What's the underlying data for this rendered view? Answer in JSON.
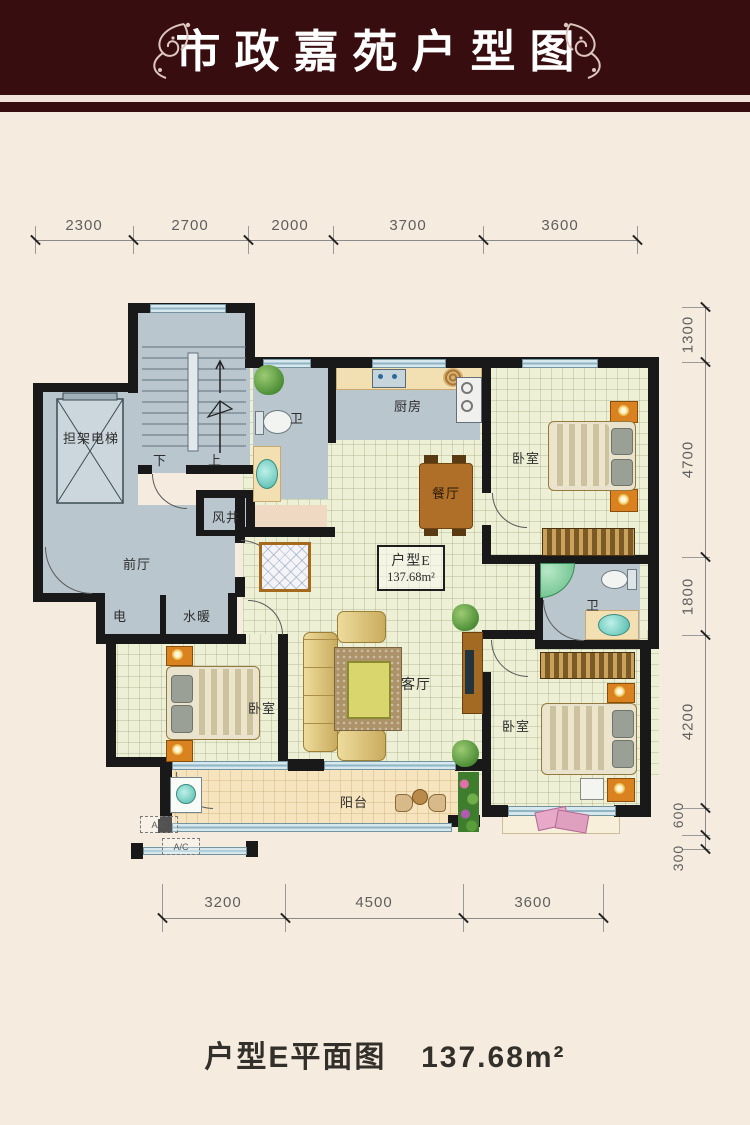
{
  "header": {
    "title": "市政嘉苑户型图"
  },
  "plan": {
    "unit_box": {
      "name": "户型E",
      "area": "137.68m²"
    },
    "labels": {
      "elevator": "担架电梯",
      "stair_down": "下",
      "stair_up": "上",
      "air_shaft": "风井",
      "front_hall": "前厅",
      "electric": "电",
      "plumbing": "水暖",
      "bath_top": "卫",
      "kitchen": "厨房",
      "dining": "餐厅",
      "bedroom_top_right": "卧室",
      "bath_right": "卫",
      "living": "客厅",
      "bedroom_left": "卧室",
      "bedroom_bottom_right": "卧室",
      "balcony": "阳台",
      "ac_1": "A/C",
      "ac_2": "A/C"
    },
    "dimensions": {
      "top": [
        "2300",
        "2700",
        "2000",
        "3700",
        "3600"
      ],
      "right": [
        "1300",
        "4700",
        "1800",
        "4200",
        "600",
        "300"
      ],
      "bottom": [
        "3200",
        "4500",
        "3600"
      ]
    }
  },
  "caption": {
    "title": "户型E平面图",
    "area": "137.68m²"
  },
  "colors": {
    "banner": "#380d10",
    "wall": "#191919",
    "common_area": "#b9c6ce",
    "room_floor": "#edf0d5",
    "balcony_floor": "#f6e4bf",
    "window": "#d6e8ee"
  }
}
